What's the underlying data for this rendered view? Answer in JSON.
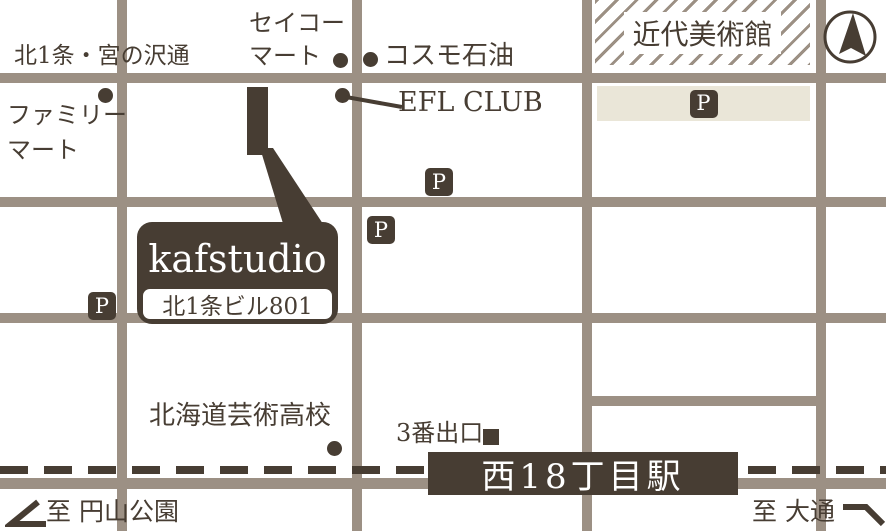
{
  "colors": {
    "dark": "#473d33",
    "road": "#9c9084",
    "beige": "#eae6d8",
    "background": "#ffffff"
  },
  "labels": {
    "avenue": "北1条・宮の沢通",
    "family_mart_line1": "ファミリー",
    "family_mart_line2": "マート",
    "seiko_mart_line1": "セイコー",
    "seiko_mart_line2": "マート",
    "cosmo_oil": "コスモ石油",
    "efl_club": "EFL CLUB",
    "museum": "近代美術館",
    "parking": "P",
    "studio_name": "kafstudio",
    "studio_address": "北1条ビル801",
    "high_school": "北海道芸術高校",
    "exit_3": "3番出口",
    "station": "西18丁目駅",
    "to_maruyama_park": "至 円山公園",
    "to_odori": "至 大通"
  }
}
